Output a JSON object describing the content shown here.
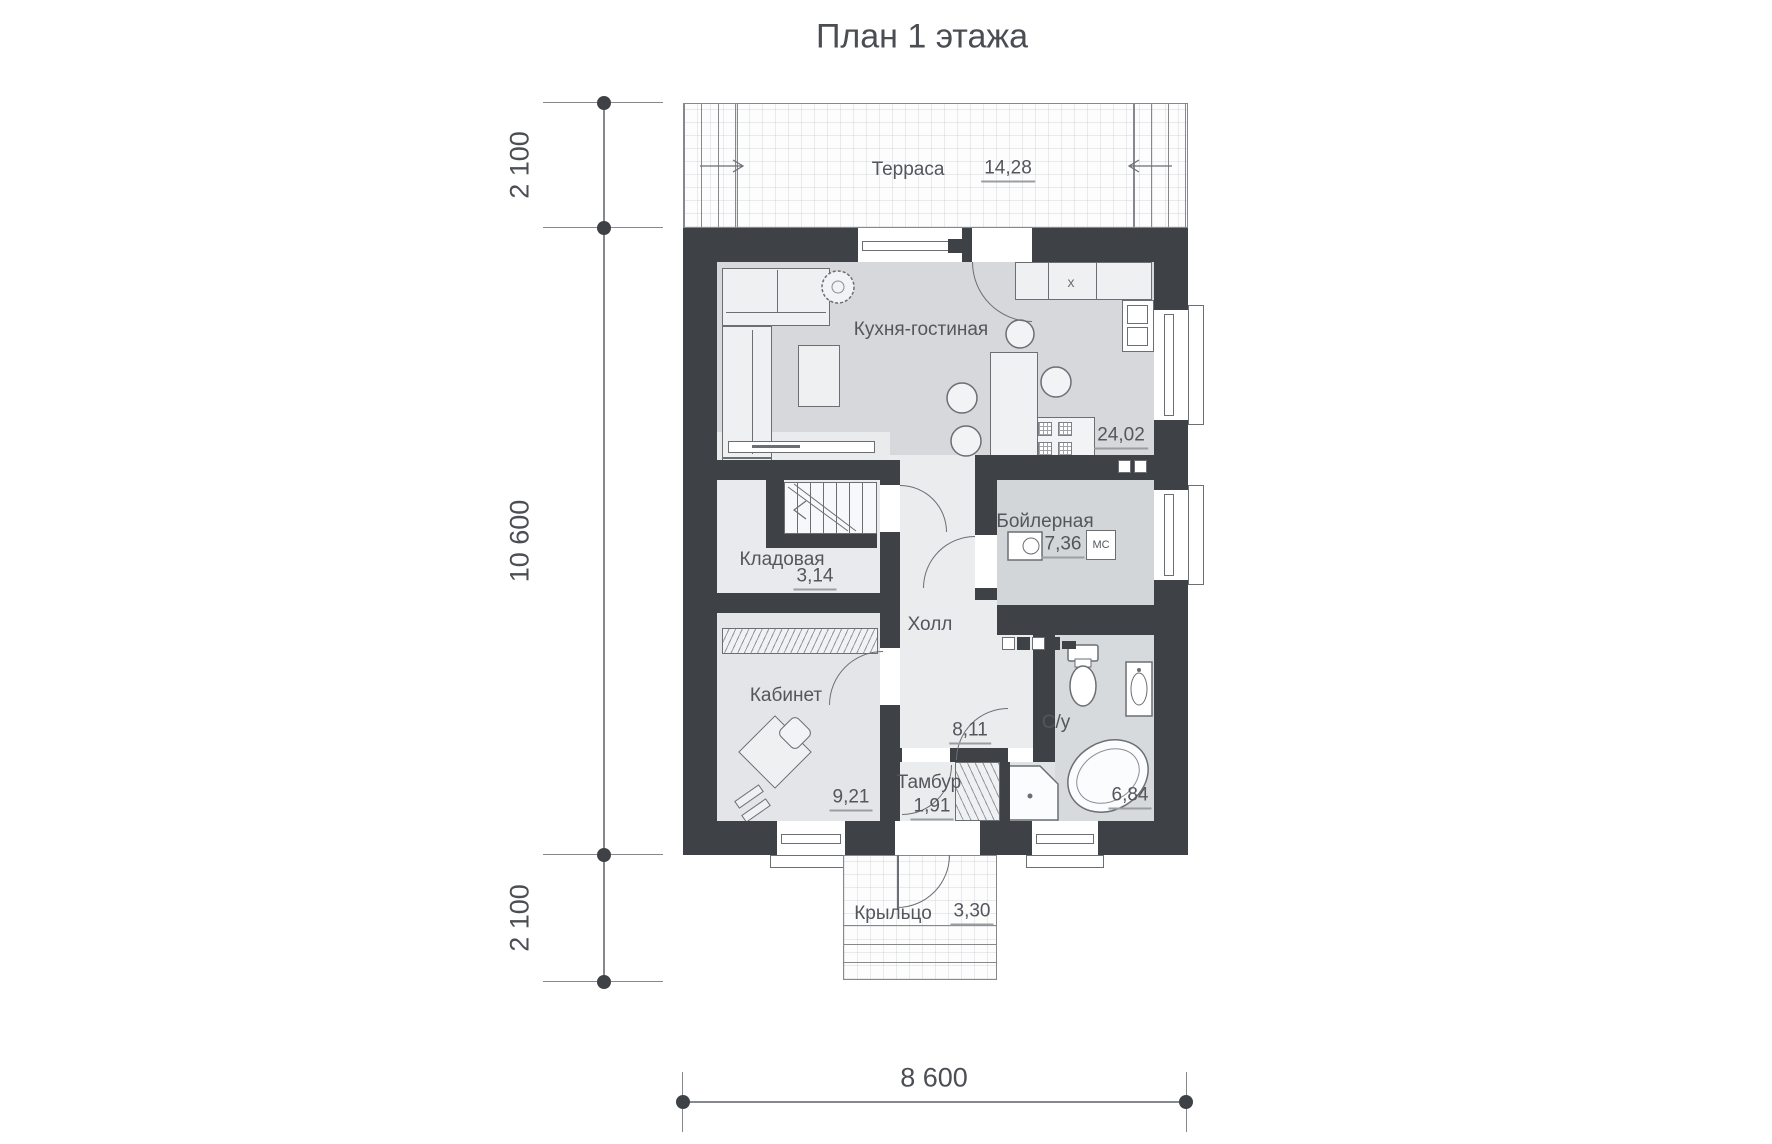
{
  "title": "План 1 этажа",
  "rooms": {
    "terrace": {
      "label": "Терраса",
      "area": "14,28"
    },
    "kitchen_living": {
      "label": "Кухня-гостиная",
      "area": "24,02"
    },
    "storage": {
      "label": "Кладовая",
      "area": "3,14"
    },
    "boiler": {
      "label": "Бойлерная",
      "area": "7,36"
    },
    "hall": {
      "label": "Холл",
      "area": "8,11"
    },
    "office": {
      "label": "Кабинет",
      "area": "9,21"
    },
    "bathroom": {
      "label": "С/у",
      "area": "6,84"
    },
    "vestibule": {
      "label": "Тамбур",
      "area": "1,91"
    },
    "porch": {
      "label": "Крыльцо",
      "area": "3,30"
    }
  },
  "dimensions": {
    "left_top": "2 100",
    "left_middle": "10 600",
    "left_bottom": "2 100",
    "bottom": "8 600"
  },
  "annotations": {
    "sink_mark": "x",
    "boiler_unit": "МС"
  },
  "colors": {
    "wall": "#3e4145",
    "kitchen_floor": "#d6d8db",
    "hall_floor": "#eaecee",
    "boiler_floor": "#d3d6d9",
    "bath_floor": "#d7dadd",
    "office_floor": "#e3e5e8",
    "storage_floor": "#e8eaed",
    "text": "#53565c"
  }
}
